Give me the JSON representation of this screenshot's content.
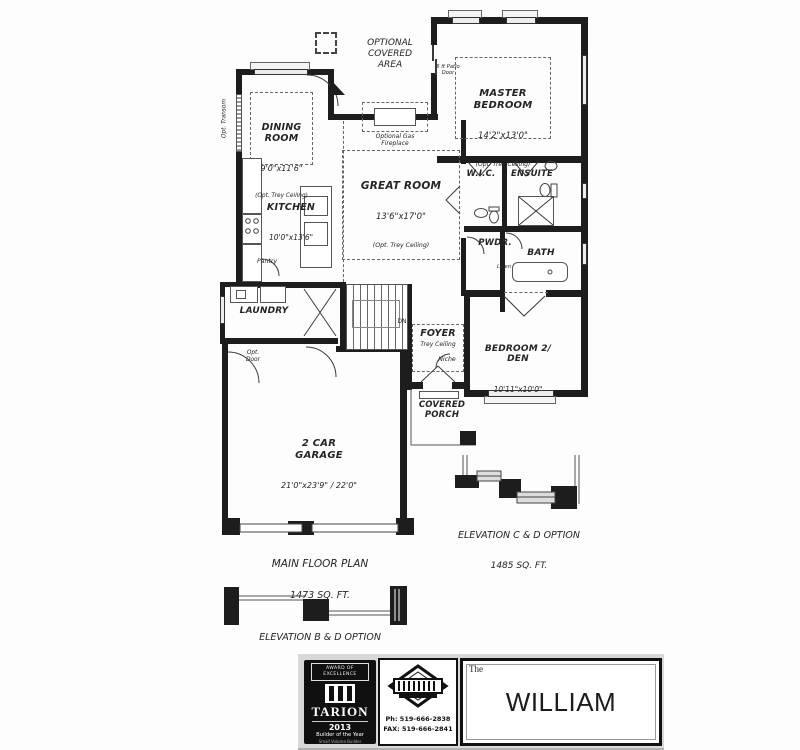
{
  "rooms": {
    "optional_covered_area": "OPTIONAL\nCOVERED\nAREA",
    "dining": {
      "name": "DINING\nROOM",
      "dims": "9'0\"x11'6\"",
      "note": "(Opt. Trey Ceiling)"
    },
    "master": {
      "name": "MASTER\nBEDROOM",
      "dims": "14'2\"x13'0\"",
      "note": "(Opt. Trey Ceiling)",
      "door_note": "6 ft Patio\nDoor"
    },
    "great": {
      "name": "GREAT ROOM",
      "dims": "13'6\"x17'0\"",
      "note": "(Opt. Trey Ceiling)",
      "fireplace": "Optional Gas\nFireplace"
    },
    "kitchen": {
      "name": "KITCHEN",
      "dims": "10'0\"x13'6\""
    },
    "wic": "W.I.C.",
    "ensuite": "ENSUITE",
    "pwdr": "PWDR.",
    "bath": "BATH",
    "linen": "Linen",
    "pantry": "Pantry",
    "laundry": "LAUNDRY",
    "opt_door": "Opt.\nDoor",
    "opt_transom": "Opt. Transom",
    "foyer": {
      "name": "FOYER",
      "note": "Trey Ceiling",
      "niche": "Niche",
      "dn": "DN"
    },
    "bedroom2": {
      "name": "BEDROOM 2/\nDEN",
      "dims": "10'11\"x10'0\""
    },
    "porch": "COVERED\nPORCH",
    "garage": {
      "name": "2 CAR\nGARAGE",
      "dims": "21'0\"x23'9\" / 22'0\""
    }
  },
  "captions": {
    "main_floor": {
      "line1": "MAIN FLOOR PLAN",
      "line2": "1473 SQ. FT."
    },
    "elev_cd": {
      "line1": "ELEVATION C & D OPTION",
      "line2": "1485 SQ. FT."
    },
    "elev_bd": "ELEVATION B & D OPTION"
  },
  "title_block": {
    "tarion": {
      "award": "AWARD OF\nEXCELLENCE",
      "brand": "TARION",
      "year": "2013",
      "honor": "Builder of the Year",
      "category": "Small Volume Builder"
    },
    "builder": {
      "phone": "Ph: 519-666-2838",
      "fax": "FAX: 519-666-2841"
    },
    "model": {
      "prefix": "The",
      "name": "WILLIAM"
    }
  }
}
